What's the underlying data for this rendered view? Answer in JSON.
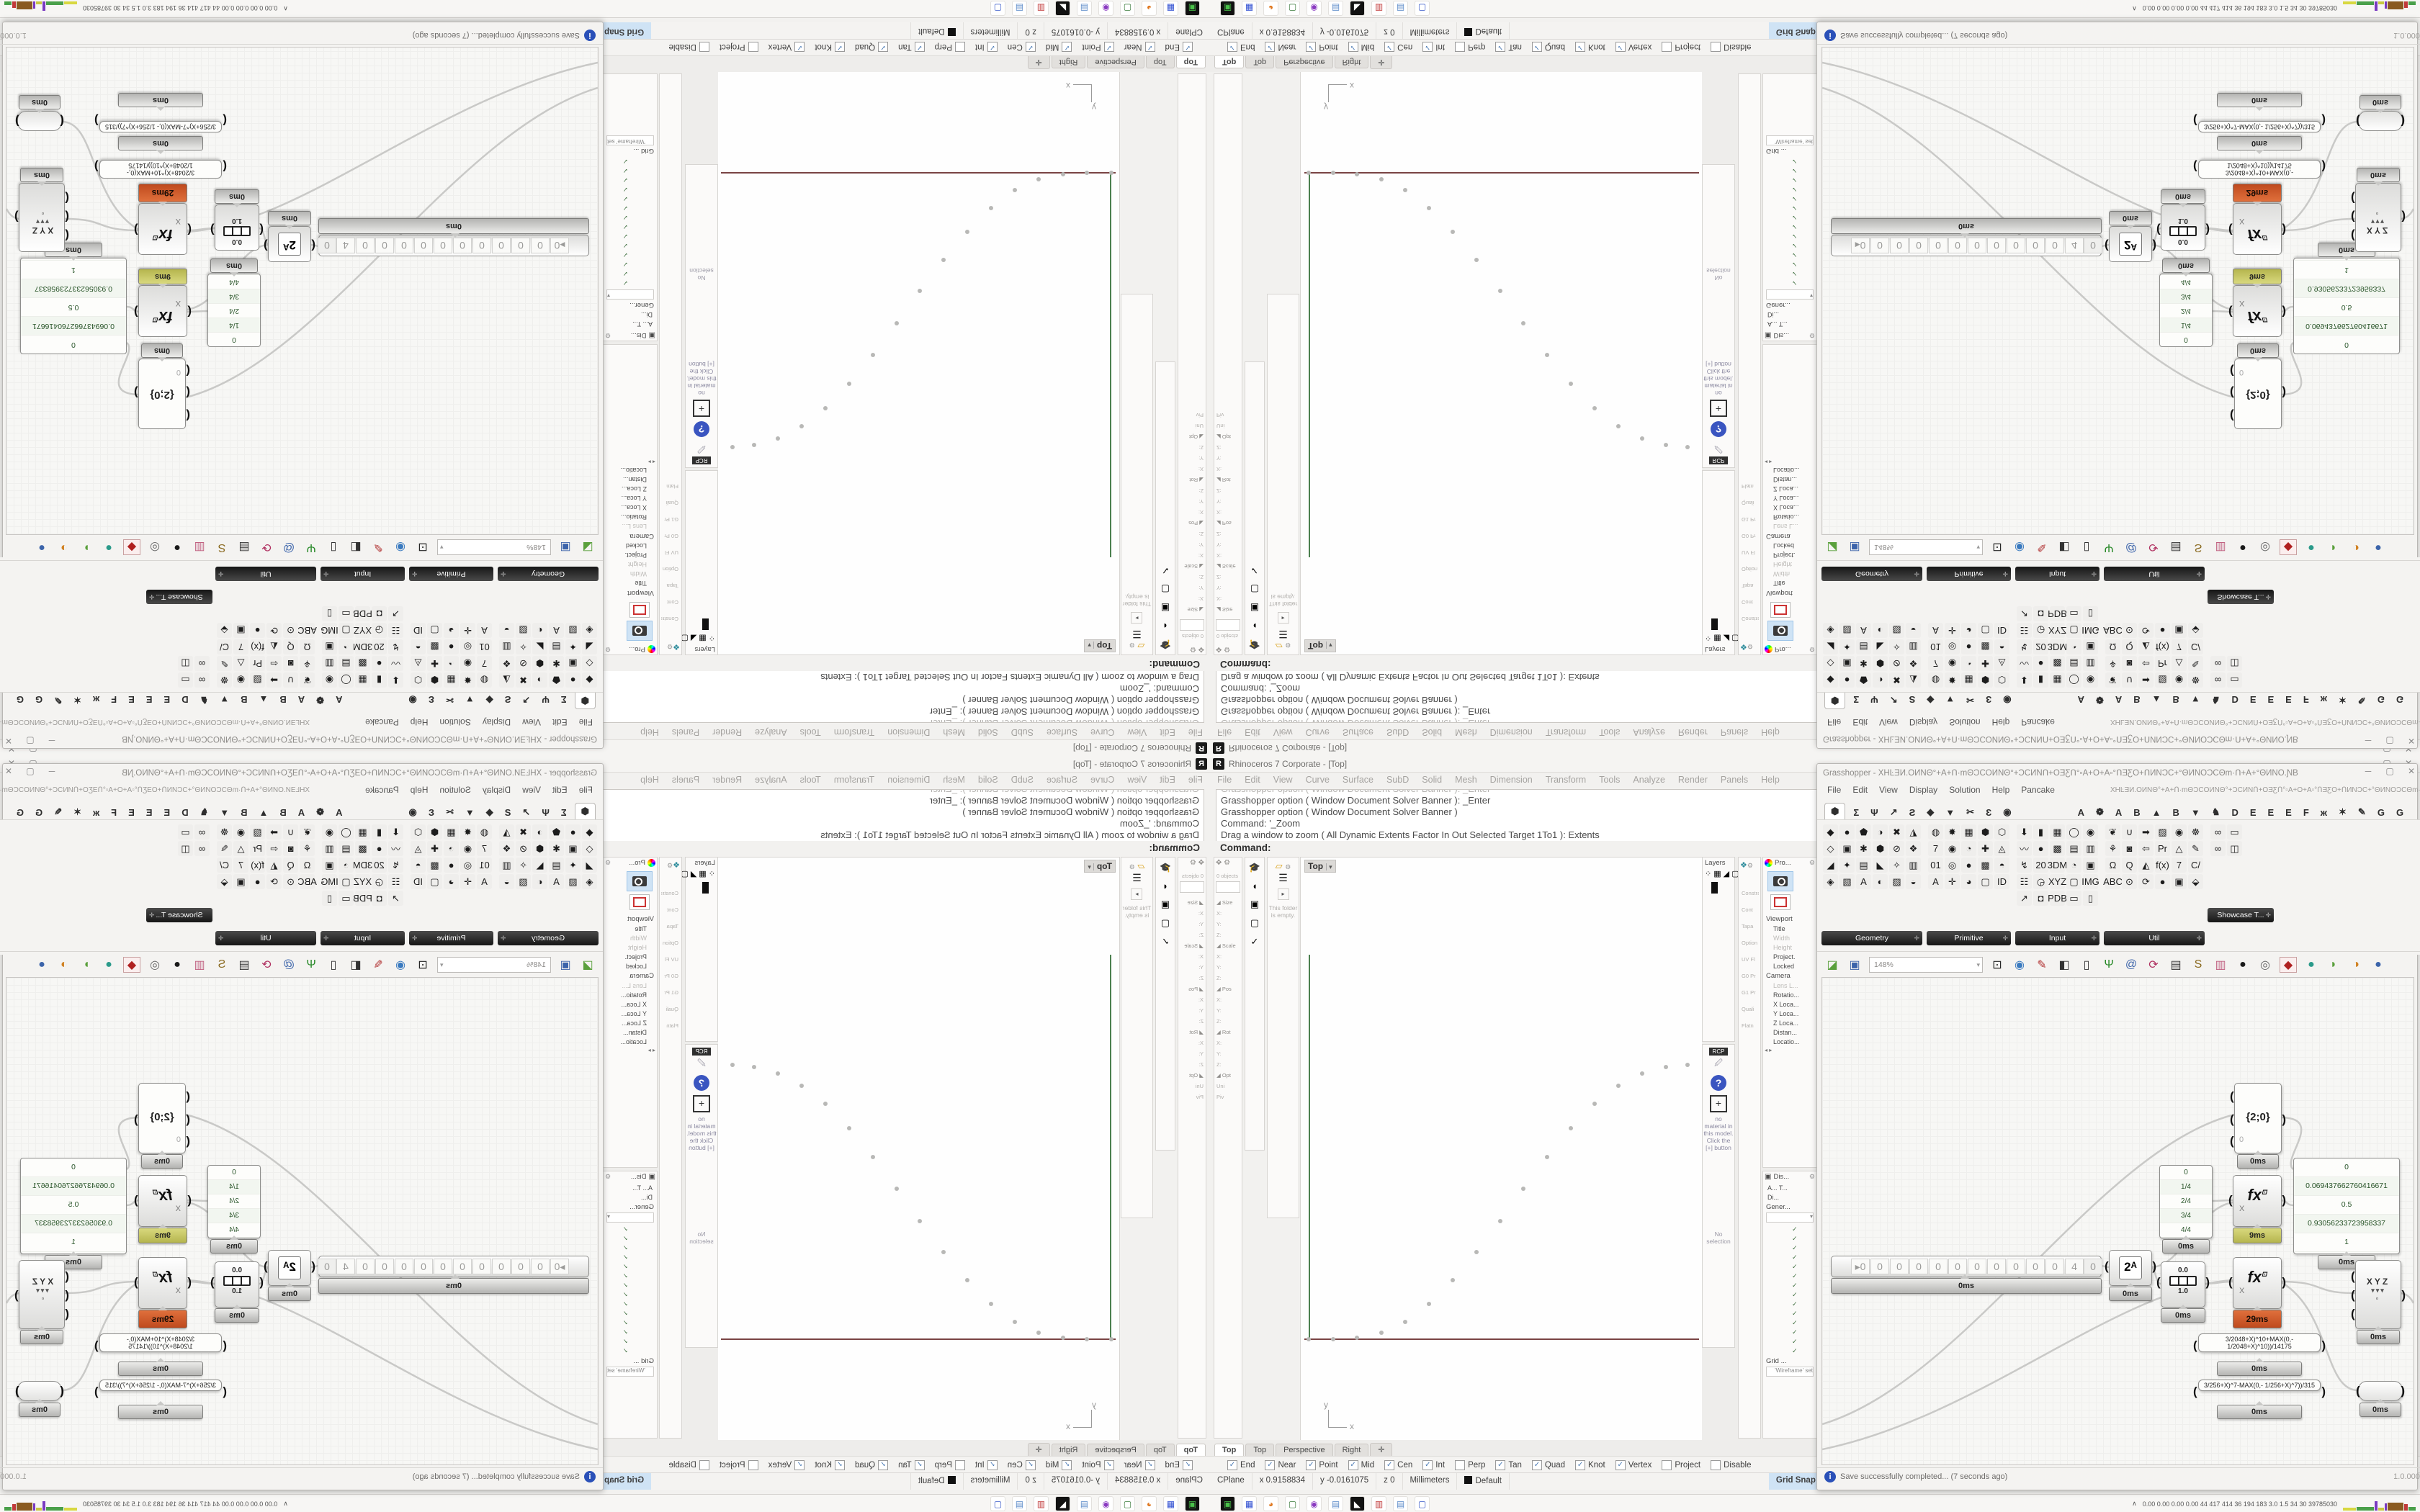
{
  "taskbar": {
    "icons": [
      {
        "g": "▣",
        "c": "#4ac14a",
        "bg": "#111111"
      },
      {
        "g": "▦",
        "c": "#2a4ad0",
        "bg": "#ffffff"
      },
      {
        "g": "◕",
        "c": "#e07820",
        "bg": "#ffffff"
      },
      {
        "g": "▢",
        "c": "#3a7a3a",
        "bg": "#ffffff"
      },
      {
        "g": "◉",
        "c": "#8a3ac1",
        "bg": "#ffffff"
      },
      {
        "g": "▤",
        "c": "#5a8ac8",
        "bg": "#ffffff"
      },
      {
        "g": "◣",
        "c": "#ffffff",
        "bg": "#111111"
      },
      {
        "g": "▥",
        "c": "#c13a3a",
        "bg": "#ffffff"
      },
      {
        "g": "▤",
        "c": "#5a8ac8",
        "bg": "#ffffff"
      },
      {
        "g": "▢",
        "c": "#3a5ac8",
        "bg": "#ffffff"
      }
    ],
    "tray_chevron": "∧",
    "tray_text": "0.00 0.00 0.00 0.00   44   417 414   36   194 183   3.0   1.5   34   30   39785030",
    "graph": [
      {
        "c": "#d8d840",
        "w": 18,
        "h": 4
      },
      {
        "c": "#4aa04a",
        "w": 24,
        "h": 5
      },
      {
        "c": "#7a3ac1",
        "w": 4,
        "h": 13
      },
      {
        "c": "#c8c840",
        "w": 8,
        "h": 4
      },
      {
        "c": "#7a3ac1",
        "w": 3,
        "h": 10
      },
      {
        "c": "#8a5a20",
        "w": 22,
        "h": 11
      },
      {
        "c": "#c13a3a",
        "w": 5,
        "h": 9
      },
      {
        "c": "#4aa04a",
        "w": 10,
        "h": 5
      }
    ]
  },
  "rhino": {
    "title": "Rhinoceros 7 Corporate - [Top]",
    "icon_letter": "R",
    "window_buttons": [
      "─",
      "▢",
      "✕"
    ],
    "menu": [
      "File",
      "Edit",
      "View",
      "Curve",
      "Surface",
      "SubD",
      "Solid",
      "Mesh",
      "Dimension",
      "Transform",
      "Tools",
      "Analyze",
      "Render",
      "Panels",
      "Help"
    ],
    "command_partial": "Grasshopper option ( Window  Document  Solver  Banner ):  _Enter",
    "command_history": [
      "Grasshopper option ( Window  Document  Solver  Banner ):  _Enter",
      "Grasshopper option ( Window  Document  Solver  Banner )",
      "Command: '_Zoom",
      "Drag a window to zoom ( All  Dynamic  Extents  Factor  In  Out  Selected  Target  1To1 ):  Extents"
    ],
    "command_prompt": "Command:",
    "boxedit": {
      "gear": "⚙",
      "move_icon": "✥",
      "header": "0 objects",
      "rows": [
        "◢ Size",
        "X:",
        "Y:",
        "Z:",
        "◢ Scale",
        "X:",
        "Y:",
        "Z:",
        "◢ Pos",
        "X:",
        "Y:",
        "Z:",
        "◢ Rot",
        "X:",
        "Y:",
        "Z:",
        "◢ Opt",
        "Uni",
        "Piv"
      ]
    },
    "tool_column_icons": [
      "🎓",
      "◖",
      "▣",
      "▢",
      "✓"
    ],
    "folder_panel": {
      "folder_icon": "▱",
      "menu_icon": "☰",
      "arrow": "▸",
      "text": "This folder is empty."
    },
    "viewport": {
      "label": "Top",
      "dropdown": "▾",
      "axis_x_label": "x",
      "axis_y_label": "y",
      "points": [
        [
          11,
          669
        ],
        [
          45,
          669
        ],
        [
          78,
          667
        ],
        [
          112,
          660
        ],
        [
          145,
          645
        ],
        [
          178,
          620
        ],
        [
          211,
          587
        ],
        [
          244,
          548
        ],
        [
          277,
          505
        ],
        [
          309,
          460
        ],
        [
          342,
          416
        ],
        [
          375,
          376
        ],
        [
          408,
          342
        ],
        [
          441,
          317
        ],
        [
          474,
          300
        ],
        [
          507,
          291
        ],
        [
          537,
          288
        ]
      ]
    },
    "layers": {
      "title": "Layers",
      "icons": [
        "⁘",
        "▦",
        "◢",
        "▢",
        "▣"
      ]
    },
    "narrow_labels": [
      "Constra",
      "Cont",
      "Tapa",
      "Option",
      "UV Fl",
      "G0 Pr",
      "G1 Pr",
      "Quali",
      "Flatn"
    ],
    "materials": {
      "tab": "RCP",
      "brush": "🖌",
      "help": "?",
      "plus": "+",
      "empty_text": "no material in this model. Click the [+] button",
      "selection": "No selection"
    },
    "properties": {
      "tab": "Pro...",
      "rows": [
        {
          "t": "Viewport",
          "s": 1
        },
        {
          "t": "Title"
        },
        {
          "t": "Width",
          "d": 1
        },
        {
          "t": "Height",
          "d": 1
        },
        {
          "t": "Project."
        },
        {
          "t": "Locked"
        },
        {
          "t": "Camera",
          "s": 1
        },
        {
          "t": "Lens L...",
          "d": 1
        },
        {
          "t": "Rotatio..."
        },
        {
          "t": "X Loca..."
        },
        {
          "t": "Y Loca..."
        },
        {
          "t": "Z Loca..."
        },
        {
          "t": "Distan..."
        },
        {
          "t": "Locatio..."
        }
      ],
      "pager": "◂ ▸"
    },
    "display": {
      "tab": "Dis...",
      "tabs_ab": "A...   T...",
      "di": "Di...",
      "gener": "Gener...",
      "checks": 14,
      "check_glyph": "✓",
      "grid": "Grid ...",
      "wire": "'Wireframe' set"
    },
    "viewport_tabs": [
      {
        "label": "Top",
        "active": 1
      },
      {
        "label": "Top"
      },
      {
        "label": "Perspective"
      },
      {
        "label": "Right"
      },
      {
        "label": "✛"
      }
    ],
    "osnap": [
      {
        "label": "End",
        "checked": 1
      },
      {
        "label": "Near",
        "checked": 1
      },
      {
        "label": "Point",
        "checked": 1
      },
      {
        "label": "Mid",
        "checked": 1
      },
      {
        "label": "Cen",
        "checked": 1
      },
      {
        "label": "Int",
        "checked": 1
      },
      {
        "label": "Perp",
        "checked": 0
      },
      {
        "label": "Tan",
        "checked": 1
      },
      {
        "label": "Quad",
        "checked": 1
      },
      {
        "label": "Knot",
        "checked": 1
      },
      {
        "label": "Vertex",
        "checked": 1
      },
      {
        "label": "Project",
        "checked": 0
      },
      {
        "label": "Disable",
        "checked": 0
      }
    ],
    "status": [
      {
        "t": "CPlane"
      },
      {
        "t": "x 0.9158834"
      },
      {
        "t": "y -0.0161075"
      },
      {
        "t": "z 0"
      },
      {
        "t": "Millimeters"
      },
      {
        "t": "Default",
        "swatch": 1
      },
      {
        "t": "Grid Snap",
        "hl": 1
      },
      {
        "t": "Ortho"
      },
      {
        "t": "Planar"
      },
      {
        "t": "Osnap",
        "hl": 1
      },
      {
        "t": "SmartTrack"
      },
      {
        "t": "Gumball",
        "hl": 1
      },
      {
        "t": "Record History"
      },
      {
        "t": "Filter"
      }
    ]
  },
  "gh": {
    "title_prefix": "Grasshopper - ",
    "doc_title": "XHĿƎИ.OИNΘ°+A+Ո·mΘƆCOИNΘ°+ƆCИNՈ+OƎƸՈ°▫A+O+A▫°ՈƎƸO+ՈИNƆC+°ΘИNOƆCΘm·Ո+A+°ΘИNO.ƝB",
    "window_buttons": [
      "─",
      "▢",
      "✕"
    ],
    "menu": [
      "File",
      "Edit",
      "View",
      "Display",
      "Solution",
      "Help",
      "Pancake"
    ],
    "tabs_main": [
      "⬢",
      "Σ",
      "Ψ",
      "↗",
      "Ƨ",
      "◆",
      "▼",
      "✂",
      "Ɛ",
      "◉"
    ],
    "tabs_plugin": [
      "A",
      "❁",
      "A",
      "B",
      "▲",
      "B",
      "▼",
      "♞",
      "D",
      "E",
      "E",
      "E",
      "F",
      "ж",
      "✶",
      "✎",
      "G",
      "G"
    ],
    "palette": [
      {
        "name": "Geometry",
        "cols": 6,
        "icons": [
          "◆",
          "●",
          "⬟",
          "◑",
          "✖",
          "◮",
          "◇",
          "▣",
          "✱",
          "⬢",
          "⊘",
          "❖",
          "◢",
          "✦",
          "▤",
          "◣",
          "✧",
          "▥",
          "◈",
          "▧",
          "A",
          "◐",
          "▨",
          "◒"
        ]
      },
      {
        "name": "Primitive",
        "cols": 5,
        "icons": [
          "◍",
          "✸",
          "▦",
          "⬢",
          "⬡",
          "7",
          "◉",
          "◔",
          "✚",
          "◬",
          "01",
          "◎",
          "●",
          "▩",
          "◓",
          "A",
          "✛",
          "◕",
          "▢",
          "ID"
        ]
      },
      {
        "name": "Input",
        "cols": 5,
        "icons": [
          "⬇",
          "▮",
          "▦",
          "◯",
          "◉",
          "〰",
          "●",
          "▩",
          "▤",
          "▥",
          "↯",
          "20",
          "3DM",
          "◔",
          "▣",
          "☷",
          "◶",
          "XYZ",
          "▢",
          "IMG",
          "↗",
          "◘",
          "PDB",
          "▭",
          "▯"
        ]
      },
      {
        "name": "Util",
        "cols": 6,
        "icons": [
          "❦",
          "∪",
          "➡",
          "▨",
          "◉",
          "☸",
          "⚘",
          "◙",
          "⇦",
          "Pr",
          "△",
          "✎",
          "Ω",
          "Q",
          "◭",
          "f(x)",
          "7",
          "C/",
          "ABC",
          "⊙",
          "⟳",
          "●",
          "▣",
          "⬙"
        ]
      },
      {
        "name": "Showcase T...",
        "cols": 2,
        "icons": [
          "∞",
          "▭",
          "∞",
          "◫"
        ],
        "float": 1
      }
    ],
    "toolbar": {
      "zoom": "148%",
      "icons": [
        {
          "g": "◪",
          "c": "#5aa03c"
        },
        {
          "g": "▣",
          "c": "#3c64aa"
        },
        {
          "g": "zoom"
        },
        {
          "g": "⊡",
          "c": "#222222"
        },
        {
          "g": "◉",
          "c": "#3a7abf"
        },
        {
          "g": "✎",
          "c": "#b03030"
        },
        {
          "g": "◧",
          "c": "#333333"
        },
        {
          "g": "▯",
          "c": "#333333"
        },
        {
          "g": "Ψ",
          "c": "#2a8a2a"
        },
        {
          "g": "@",
          "c": "#3c64aa"
        },
        {
          "g": "⟳",
          "c": "#b03060"
        },
        {
          "g": "▤",
          "c": "#333333"
        },
        {
          "g": "S",
          "c": "#8a6a20"
        },
        {
          "g": "▥",
          "c": "#c06080"
        },
        {
          "g": "●",
          "c": "#1a1a1a"
        },
        {
          "g": "◎",
          "c": "#666666"
        },
        {
          "g": "◆",
          "c": "#b02020",
          "boxed": 1
        },
        {
          "g": "●",
          "c": "#2a9a8a"
        },
        {
          "g": "◗",
          "c": "#5aa03c"
        },
        {
          "g": "◑",
          "c": "#d08020"
        },
        {
          "g": "●",
          "c": "#3c64aa"
        }
      ]
    },
    "canvas": {
      "slider": {
        "prefix": "▸",
        "cells": [
          "0",
          "0",
          "0",
          "0",
          "0",
          "0",
          "0",
          "0",
          "0",
          "0",
          "0",
          "4"
        ],
        "tail": "0",
        "tag": "0ms"
      },
      "pow": {
        "glyph": "2ᴬ",
        "tag": "0ms"
      },
      "domain": {
        "top": "0.0",
        "bottom": "1.0",
        "tag": "0ms"
      },
      "pathviewer": {
        "text": "{2;0}",
        "hint": "0",
        "tag": "0ms"
      },
      "fx_top": {
        "glyph": "fx",
        "sup": "⊡",
        "input": "X",
        "tag": "9ms"
      },
      "fx_bottom": {
        "glyph": "fx",
        "sup": "⊡",
        "input": "X",
        "tag": "29ms"
      },
      "panel_fractions": {
        "rows": [
          "0",
          "1/4",
          "2/4",
          "3/4",
          "4/4"
        ],
        "tag": "0ms"
      },
      "panel_values": {
        "rows": [
          "0",
          "0.069437662760416671",
          "0.5",
          "0.93056233723958337",
          "1"
        ],
        "tag": "0ms"
      },
      "formula1": {
        "text": "3/2048+X)^10+MAX(0,- 1/2048+X)^10))/14175",
        "tag": "0ms"
      },
      "formula2": {
        "text": "3/256+X)^7-MAX(0,- 1/256+X)^7))/315",
        "tag": "0ms"
      },
      "xyz": {
        "x": "X",
        "y": "Y",
        "z": "Z",
        "point": "◦",
        "tag": "0ms"
      },
      "relay": {
        "tag": "0ms"
      }
    },
    "status": {
      "message": "Save successfully completed... (7 seconds ago)",
      "version": "1.0.0007"
    }
  }
}
